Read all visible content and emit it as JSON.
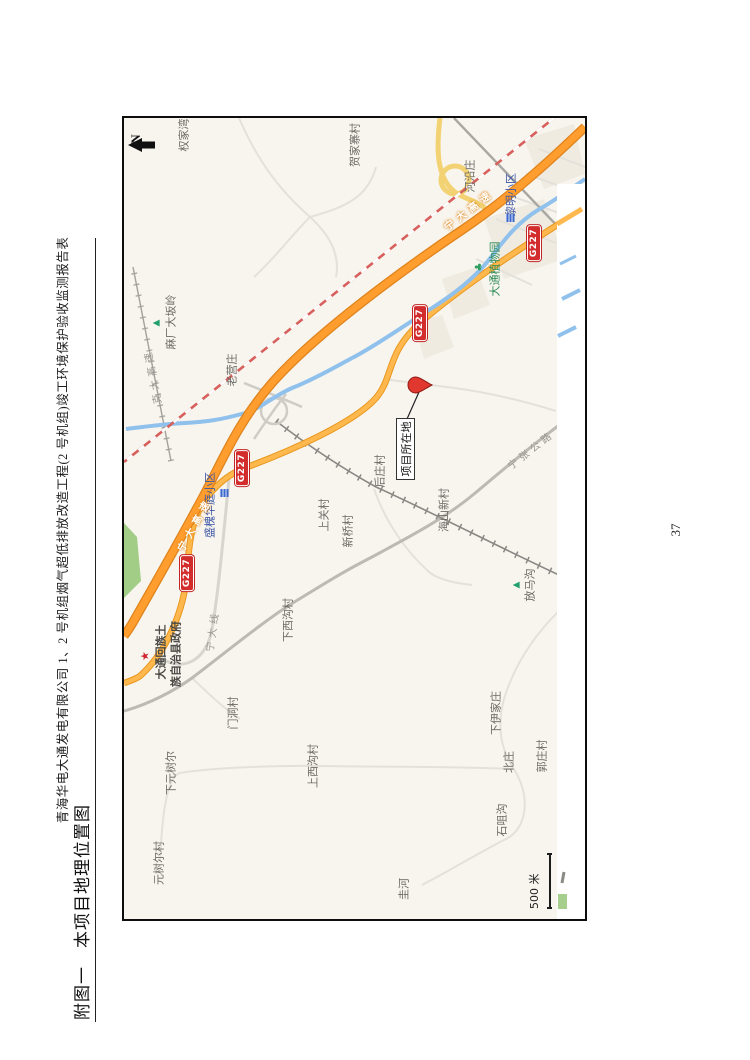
{
  "page": {
    "header": "青海华电大通发电有限公司 1、2 号机组烟气超低排放改造工程(2 号机组)竣工环境保护验收监测报告表",
    "title": "附图一　本项目地理位置图",
    "page_number": "37"
  },
  "map": {
    "north_label": "N",
    "scale_label": "500 米",
    "project_label": "项目所在地",
    "colors": {
      "expressway": "#ff9d2e",
      "national_road": "#ffb84d",
      "ramp_yellow": "#f2d272",
      "river": "#8fc1ec",
      "railway_red": "#d75f5c",
      "shield_red": "#d22c2c",
      "pin_red": "#e0382e",
      "green_area": "#a2cd86"
    },
    "labels": [
      {
        "text": "权家湾",
        "x": 784,
        "y": 60,
        "cls": ""
      },
      {
        "text": "贺家寨村",
        "x": 774,
        "y": 231,
        "cls": ""
      },
      {
        "text": "河沿庄",
        "x": 743,
        "y": 346,
        "cls": ""
      },
      {
        "text": "老营庄",
        "x": 549,
        "y": 108,
        "cls": ""
      },
      {
        "text": "后庄村",
        "x": 448,
        "y": 256,
        "cls": ""
      },
      {
        "text": "海山新村",
        "x": 409,
        "y": 320,
        "cls": ""
      },
      {
        "text": "上关村",
        "x": 404,
        "y": 200,
        "cls": ""
      },
      {
        "text": "新桥村",
        "x": 388,
        "y": 224,
        "cls": ""
      },
      {
        "text": "门洞村",
        "x": 206,
        "y": 109,
        "cls": ""
      },
      {
        "text": "下西沟村",
        "x": 299,
        "y": 164,
        "cls": ""
      },
      {
        "text": "上西沟村",
        "x": 153,
        "y": 189,
        "cls": ""
      },
      {
        "text": "下元树尔",
        "x": 146,
        "y": 47,
        "cls": ""
      },
      {
        "text": "元树尔村",
        "x": 56,
        "y": 35,
        "cls": ""
      },
      {
        "text": "下伊家庄",
        "x": 206,
        "y": 372,
        "cls": ""
      },
      {
        "text": "北庄",
        "x": 157,
        "y": 385,
        "cls": ""
      },
      {
        "text": "郭庄村",
        "x": 163,
        "y": 418,
        "cls": ""
      },
      {
        "text": "石咀沟",
        "x": 99,
        "y": 378,
        "cls": ""
      },
      {
        "text": "圭河",
        "x": 30,
        "y": 280,
        "cls": ""
      },
      {
        "text": "放马沟",
        "x": 334,
        "y": 406,
        "cls": ""
      },
      {
        "text": "麻厂大坂岭",
        "x": 597,
        "y": 47,
        "cls": ""
      },
      {
        "text": "黎明小区",
        "x": 724,
        "y": 387,
        "cls": "lb-poiblue"
      },
      {
        "text": "盛槐华庭小区",
        "x": 414,
        "y": 86,
        "cls": "lb-poiblue"
      },
      {
        "text": "大通植物园",
        "x": 650,
        "y": 371,
        "cls": "lb-poigreen"
      },
      {
        "text": "大通回族土",
        "x": 267,
        "y": 37,
        "cls": "lb-gov"
      },
      {
        "text": "族自治县政府",
        "x": 265,
        "y": 52,
        "cls": "lb-gov"
      },
      {
        "text": "宁大高速",
        "x": 708,
        "y": 346,
        "cls": "lb-roadwhite",
        "rot": 52
      },
      {
        "text": "宁大高速",
        "x": 394,
        "y": 72,
        "cls": "lb-roadwhite",
        "rot": 29
      },
      {
        "text": "克大高速",
        "x": 543,
        "y": 30,
        "cls": "lb-roadgray",
        "rot": -11
      },
      {
        "text": "宁张公路",
        "x": 468,
        "y": 408,
        "cls": "lb-roadgray",
        "rot": 52
      },
      {
        "text": "宁大线",
        "x": 288,
        "y": 90,
        "cls": "lb-roadgray",
        "rot": 8
      }
    ],
    "icons": [
      {
        "type": "mountain",
        "x": 596,
        "y": 33
      },
      {
        "type": "mountain",
        "x": 334,
        "y": 393
      },
      {
        "type": "tree",
        "x": 652,
        "y": 356
      },
      {
        "type": "building",
        "x": 701,
        "y": 386
      },
      {
        "type": "building",
        "x": 426,
        "y": 100
      },
      {
        "type": "gov",
        "x": 263,
        "y": 21
      }
    ],
    "shields": [
      {
        "text": "G227",
        "x": 676,
        "y": 410
      },
      {
        "text": "G227",
        "x": 596,
        "y": 296
      },
      {
        "text": "G227",
        "x": 451,
        "y": 118
      },
      {
        "text": "G227",
        "x": 346,
        "y": 63
      }
    ]
  }
}
